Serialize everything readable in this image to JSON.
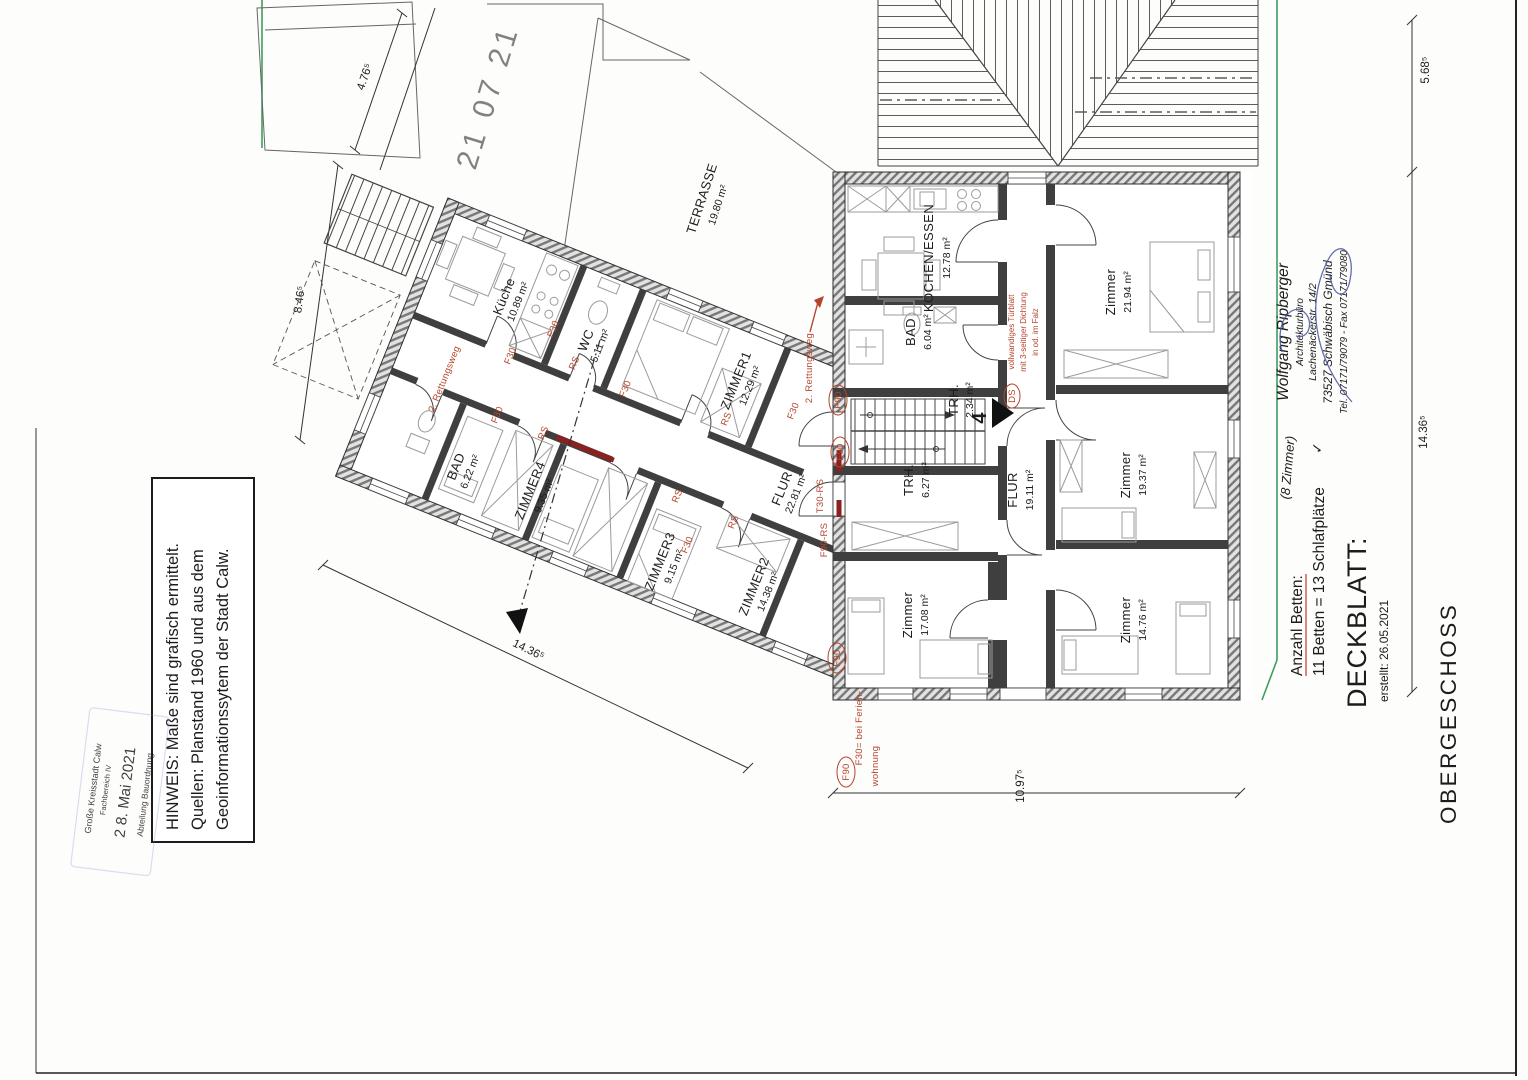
{
  "title_block": {
    "floor": "OBERGESCHOSS",
    "doc": "DECKBLATT:",
    "created": "erstellt: 26.05.2021"
  },
  "beds_note": {
    "heading": "Anzahl Betten:",
    "value": "11 Betten = 13 Schlafplätze",
    "handwritten": "(8 Zimmer)",
    "check": "✓"
  },
  "architect": {
    "name": "Wolfgang Ripberger",
    "office": "Architekturbüro",
    "street": "Lachenäckerstr. 14/2",
    "city": "73527 Schwäbisch Gmünd",
    "phone": "Tel. 07171/79079 - Fax 07171/79080"
  },
  "note_box": {
    "line1": "HINWEIS: Maße sind grafisch ermittelt.",
    "line2": "Quellen: Planstand 1960 und aus dem",
    "line3": "Geoinformationssytem der Stadt Calw."
  },
  "stamp": {
    "org": "Große Kreisstadt Calw",
    "dept_top": "Fachbereich IV",
    "date": "2 8. Mai 2021",
    "dept_bottom": "Abteilung Bauordnung"
  },
  "watermark": "21 07 21",
  "stair_number": "4",
  "rooms": {
    "terrasse": {
      "name": "TERRASSE",
      "area": "19.80 m²"
    },
    "kueche": {
      "name": "Küche",
      "area": "10.89 m²"
    },
    "wc": {
      "name": "WC",
      "area": "5.11 m²"
    },
    "zimmer1": {
      "name": "ZIMMER1",
      "area": "12.29 m²"
    },
    "bad_links": {
      "name": "BAD",
      "area": "6.22 m²"
    },
    "zimmer4": {
      "name": "ZIMMER4",
      "area": "9.35 m²"
    },
    "zimmer3": {
      "name": "ZIMMER3",
      "area": "9.15 m²"
    },
    "zimmer2": {
      "name": "ZIMMER2",
      "area": "14.38 m²"
    },
    "flur_links": {
      "name": "FLUR",
      "area": "22.81 m²"
    },
    "kochen": {
      "name": "KOCHEN/ESSEN",
      "area": "12.78 m²"
    },
    "bad_rechts": {
      "name": "BAD",
      "area": "6.04 m²"
    },
    "trh_klein": {
      "name": "TRH.",
      "area": "2.34 m²"
    },
    "trh_gross": {
      "name": "TRH.",
      "area": "6.27 m²"
    },
    "flur_rechts": {
      "name": "FLUR",
      "area": "19.11 m²"
    },
    "zimmer_no": {
      "name": "Zimmer",
      "area": "21.94 m²"
    },
    "zimmer_o": {
      "name": "Zimmer",
      "area": "19.37 m²"
    },
    "zimmer_sw": {
      "name": "Zimmer",
      "area": "17.08 m²"
    },
    "zimmer_so": {
      "name": "Zimmer",
      "area": "14.76 m²"
    }
  },
  "dimensions": {
    "top_left": "4.76⁵",
    "left": "8.46⁵",
    "top_right": "5.68⁵",
    "right": "14.36⁵",
    "bottom_left": "14.36⁵",
    "bottom": "10.97⁵"
  },
  "fire": {
    "f30": "F30",
    "f90": "F90",
    "rs": "RS",
    "f90_rs": "F90-RS",
    "t30_rs": "T30-RS",
    "ds": "DS",
    "rescue": "2. Rettungsweg",
    "ferien_line1": "F30= bei Ferien-",
    "ferien_line2": "wohnung",
    "door_note1": "vollwandiges Türblatt",
    "door_note2": "mit 3-seitiger Dichtung",
    "door_note3": "in od. im Falz"
  },
  "colors": {
    "red_label": "#b5442c",
    "red_wall": "#8e1f1f",
    "green_boundary": "#3f9d5f",
    "stamp_blue": "#7b97cc",
    "ink_blue": "#454f8f"
  }
}
